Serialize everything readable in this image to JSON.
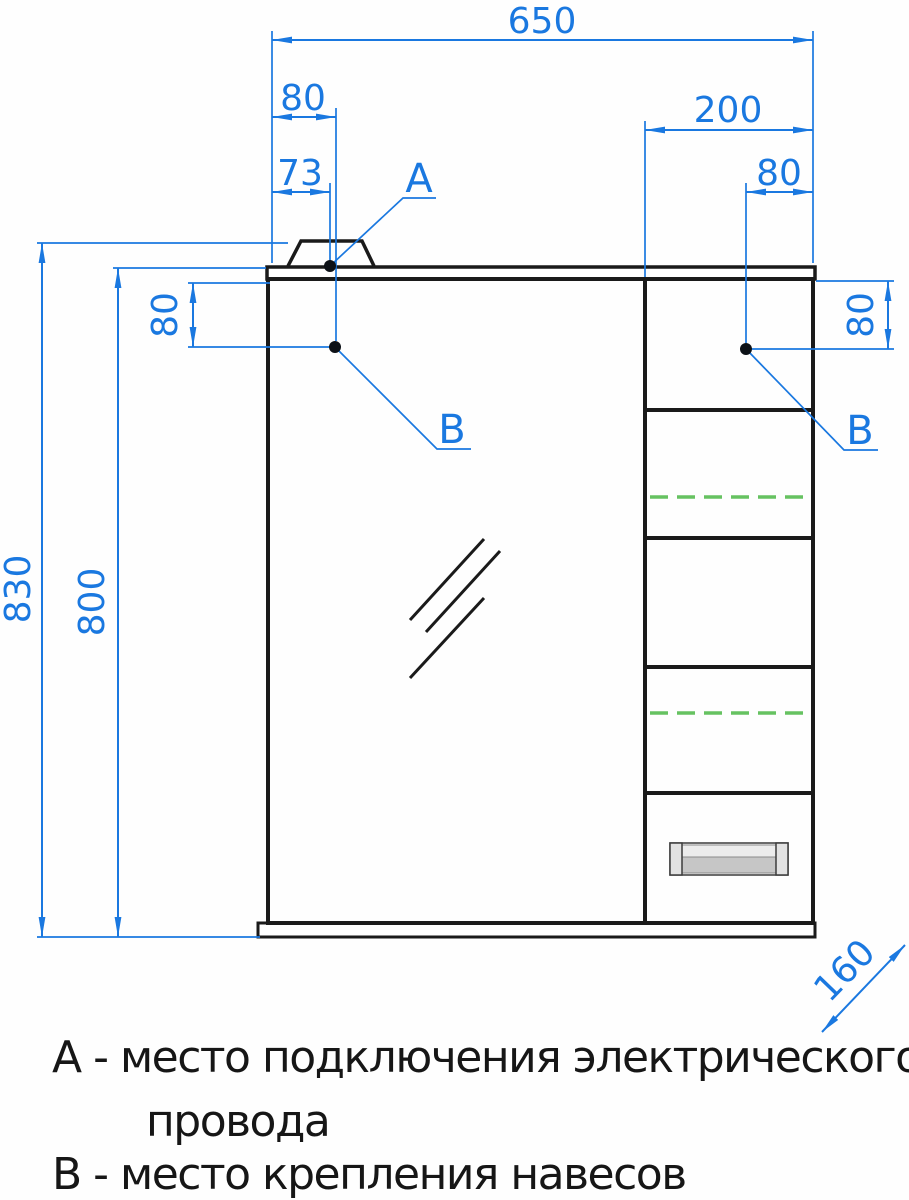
{
  "drawing": {
    "dimensions": {
      "overall_width": "650",
      "left_hinge_offset_x": "80",
      "wire_point_offset_x": "73",
      "right_section_width": "200",
      "right_hinge_offset_x": "80",
      "left_hinge_offset_y": "80",
      "right_hinge_offset_y": "80",
      "overall_height_with_cap": "830",
      "body_height": "800",
      "side_depth": "160"
    },
    "points": {
      "wire_label": "A",
      "hinge_left_label": "B",
      "hinge_right_label": "B"
    }
  },
  "legend": {
    "line1": "А - место подключения электрического",
    "line2": "провода",
    "line3": "В - место крепления навесов"
  },
  "colors": {
    "dimension_blue": "#1a78e0",
    "shelf_green": "#66c261",
    "outline_black": "#1a1a1a"
  }
}
